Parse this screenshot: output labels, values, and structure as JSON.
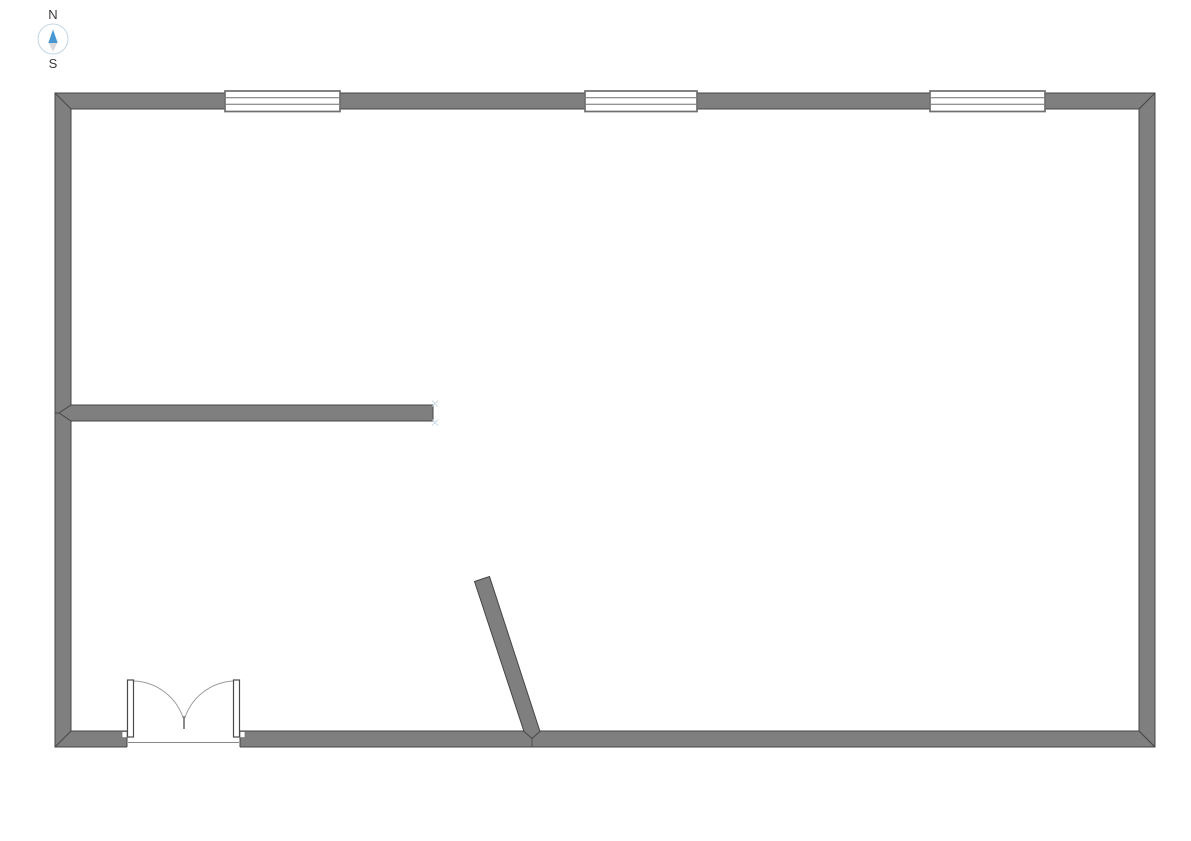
{
  "app": {
    "background": "#ffffff",
    "description": "Floor plan drawing canvas"
  },
  "compass": {
    "north_label": "N",
    "south_label": "S"
  },
  "colors": {
    "wall_fill": "#7f7f7f",
    "wall_stroke": "#454545",
    "window_line": "#6e6e6e",
    "door_leaf_stroke": "#4a4a4a",
    "door_leaf_fill": "#ffffff",
    "door_arc": "#9c9c9c",
    "door_tick": "#8a8a8a",
    "threshold_line": "#8a8a8a",
    "snap_marker": "#c9d7e6",
    "compass_north": "#4596d3",
    "compass_south": "#d9d9d9",
    "compass_ring": "#c2d6e6",
    "compass_text": "#3a3a3a"
  },
  "floor_plan": {
    "outer_wall": {
      "left": 55,
      "top": 93,
      "right": 1155,
      "bottom": 747,
      "thickness": 16
    },
    "window_band": {
      "y1": 91,
      "y2": 111.5,
      "inner_line_ys": [
        97.8,
        104.3
      ]
    },
    "top_windows": [
      {
        "x1": 225,
        "x2": 340
      },
      {
        "x1": 585,
        "x2": 697
      },
      {
        "x1": 930,
        "x2": 1045
      }
    ],
    "door": {
      "type": "double-swing",
      "opening_x1": 127,
      "opening_x2": 240,
      "leaf_width": 6,
      "leaf_top": 680,
      "leaf_bottom": 737,
      "threshold_y": 742.5,
      "jamb_notch": {
        "depth": 5,
        "height": 6
      },
      "arc_radius": 54,
      "meet_x": 184,
      "meet_y_top": 716,
      "meet_y_bottom": 729
    },
    "interior_wall": {
      "x1": 71,
      "y1": 405,
      "x2": 433,
      "y2": 421,
      "miter_tip": [
        59,
        413
      ],
      "wall_tick_x": 55,
      "end_markers": [
        [
          435,
          403.5
        ],
        [
          435,
          422.5
        ]
      ]
    },
    "angled_wall": {
      "polygon": [
        [
          474.5,
          581.5
        ],
        [
          489.5,
          576.5
        ],
        [
          540,
          731.5
        ],
        [
          532,
          738.5
        ],
        [
          524,
          731.5
        ]
      ],
      "seam_bottom": [
        [
          532,
          738.5
        ],
        [
          532,
          747
        ]
      ]
    }
  }
}
